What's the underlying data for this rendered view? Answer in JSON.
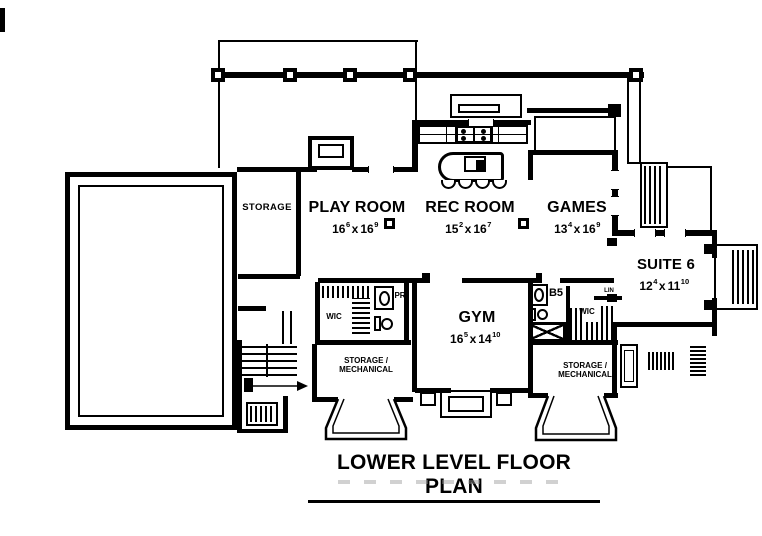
{
  "meta": {
    "title": "LOWER LEVEL FLOOR PLAN"
  },
  "colors": {
    "ink": "#000000",
    "paper": "#ffffff"
  },
  "rooms": {
    "storage": {
      "label": "STORAGE"
    },
    "play_room": {
      "label": "PLAY ROOM",
      "dim": {
        "a": "16",
        "as": "6",
        "sep": "x",
        "b": "16",
        "bs": "9"
      }
    },
    "rec_room": {
      "label": "REC ROOM",
      "dim": {
        "a": "15",
        "as": "2",
        "sep": "x",
        "b": "16",
        "bs": "7"
      }
    },
    "games": {
      "label": "GAMES",
      "dim": {
        "a": "13",
        "as": "4",
        "sep": "x",
        "b": "16",
        "bs": "9"
      }
    },
    "suite_6": {
      "label": "SUITE 6",
      "dim": {
        "a": "12",
        "as": "4",
        "sep": "x",
        "b": "11",
        "bs": "10"
      }
    },
    "gym": {
      "label": "GYM",
      "dim": {
        "a": "16",
        "as": "5",
        "sep": "x",
        "b": "14",
        "bs": "10"
      }
    },
    "wic_left": {
      "label": "WIC"
    },
    "powder_room": {
      "label": "PR"
    },
    "bath_5": {
      "label": "B5"
    },
    "wic_right": {
      "label": "WIC"
    },
    "linen": {
      "label": "LIN"
    },
    "storage_mech_left": {
      "line1": "STORAGE /",
      "line2": "MECHANICAL"
    },
    "storage_mech_right": {
      "line1": "STORAGE /",
      "line2": "MECHANICAL"
    }
  }
}
